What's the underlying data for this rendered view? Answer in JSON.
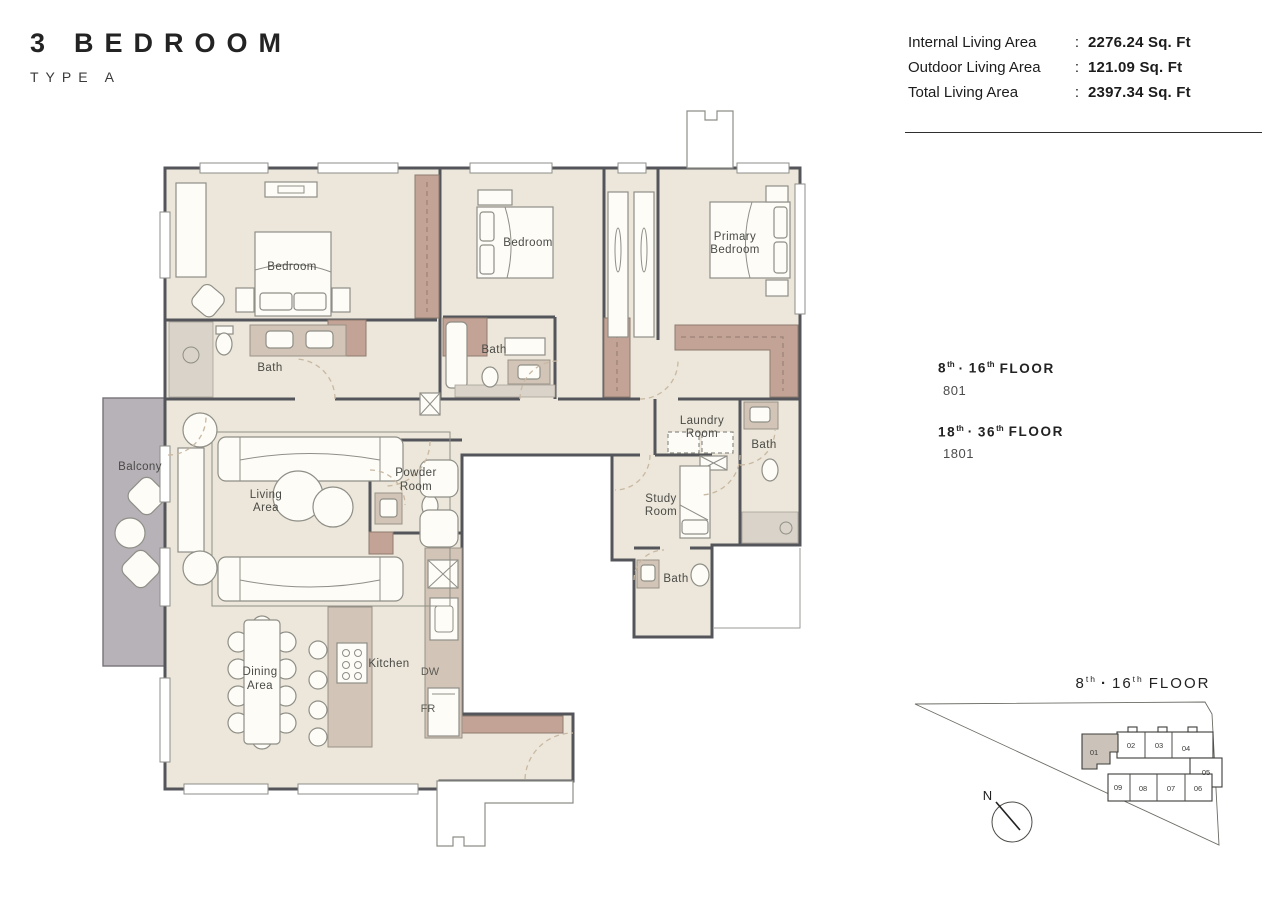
{
  "colors": {
    "floor": "#ECE7DA",
    "wall": "#54555A",
    "wood": "#C3A396",
    "wood_dark": "#8D7B6F",
    "counter": "#D2C4B6",
    "tile": "#DAD3C9",
    "balcony": "#B7B2B8",
    "label": "#4A4A46",
    "keyplan_unit": "#CBC3BA"
  },
  "header": {
    "number": "3",
    "name": "BEDROOM",
    "subtitle": "TYPE A"
  },
  "area_summary": {
    "rows": [
      {
        "label": "Internal Living Area",
        "sep": ":",
        "value": "2276.24 Sq. Ft"
      },
      {
        "label": "Outdoor Living Area",
        "sep": ":",
        "value": "121.09 Sq. Ft"
      },
      {
        "label": "Total Living Area",
        "sep": ":",
        "value": "2397.34 Sq. Ft"
      }
    ]
  },
  "floor_availability": {
    "blocks": [
      {
        "n1": "8",
        "s1": "th",
        "sep": "·",
        "n2": "16",
        "s2": "th",
        "word": "FLOOR",
        "unit": "801"
      },
      {
        "n1": "18",
        "s1": "th",
        "sep": "·",
        "n2": "36",
        "s2": "th",
        "word": "FLOOR",
        "unit": "1801"
      }
    ]
  },
  "plan": {
    "labels": {
      "bedroom_left": "Bedroom",
      "bedroom_mid": "Bedroom",
      "primary_1": "Primary",
      "primary_2": "Bedroom",
      "bath_left": "Bath",
      "bath_mid": "Bath",
      "bath_right": "Bath",
      "bath_bottom": "Bath",
      "laundry_1": "Laundry",
      "laundry_2": "Room",
      "powder_1": "Powder",
      "powder_2": "Room",
      "living_1": "Living",
      "living_2": "Area",
      "study_1": "Study",
      "study_2": "Room",
      "dining_1": "Dining",
      "dining_2": "Area",
      "kitchen": "Kitchen",
      "dw": "DW",
      "fr": "FR",
      "balcony": "Balcony"
    }
  },
  "keyplan": {
    "title": {
      "n1": "8",
      "s1": "th",
      "sep": "·",
      "n2": "16",
      "s2": "th",
      "word": "FLOOR"
    },
    "units": [
      "01",
      "02",
      "03",
      "04",
      "05",
      "06",
      "07",
      "08",
      "09"
    ],
    "north": "N"
  }
}
